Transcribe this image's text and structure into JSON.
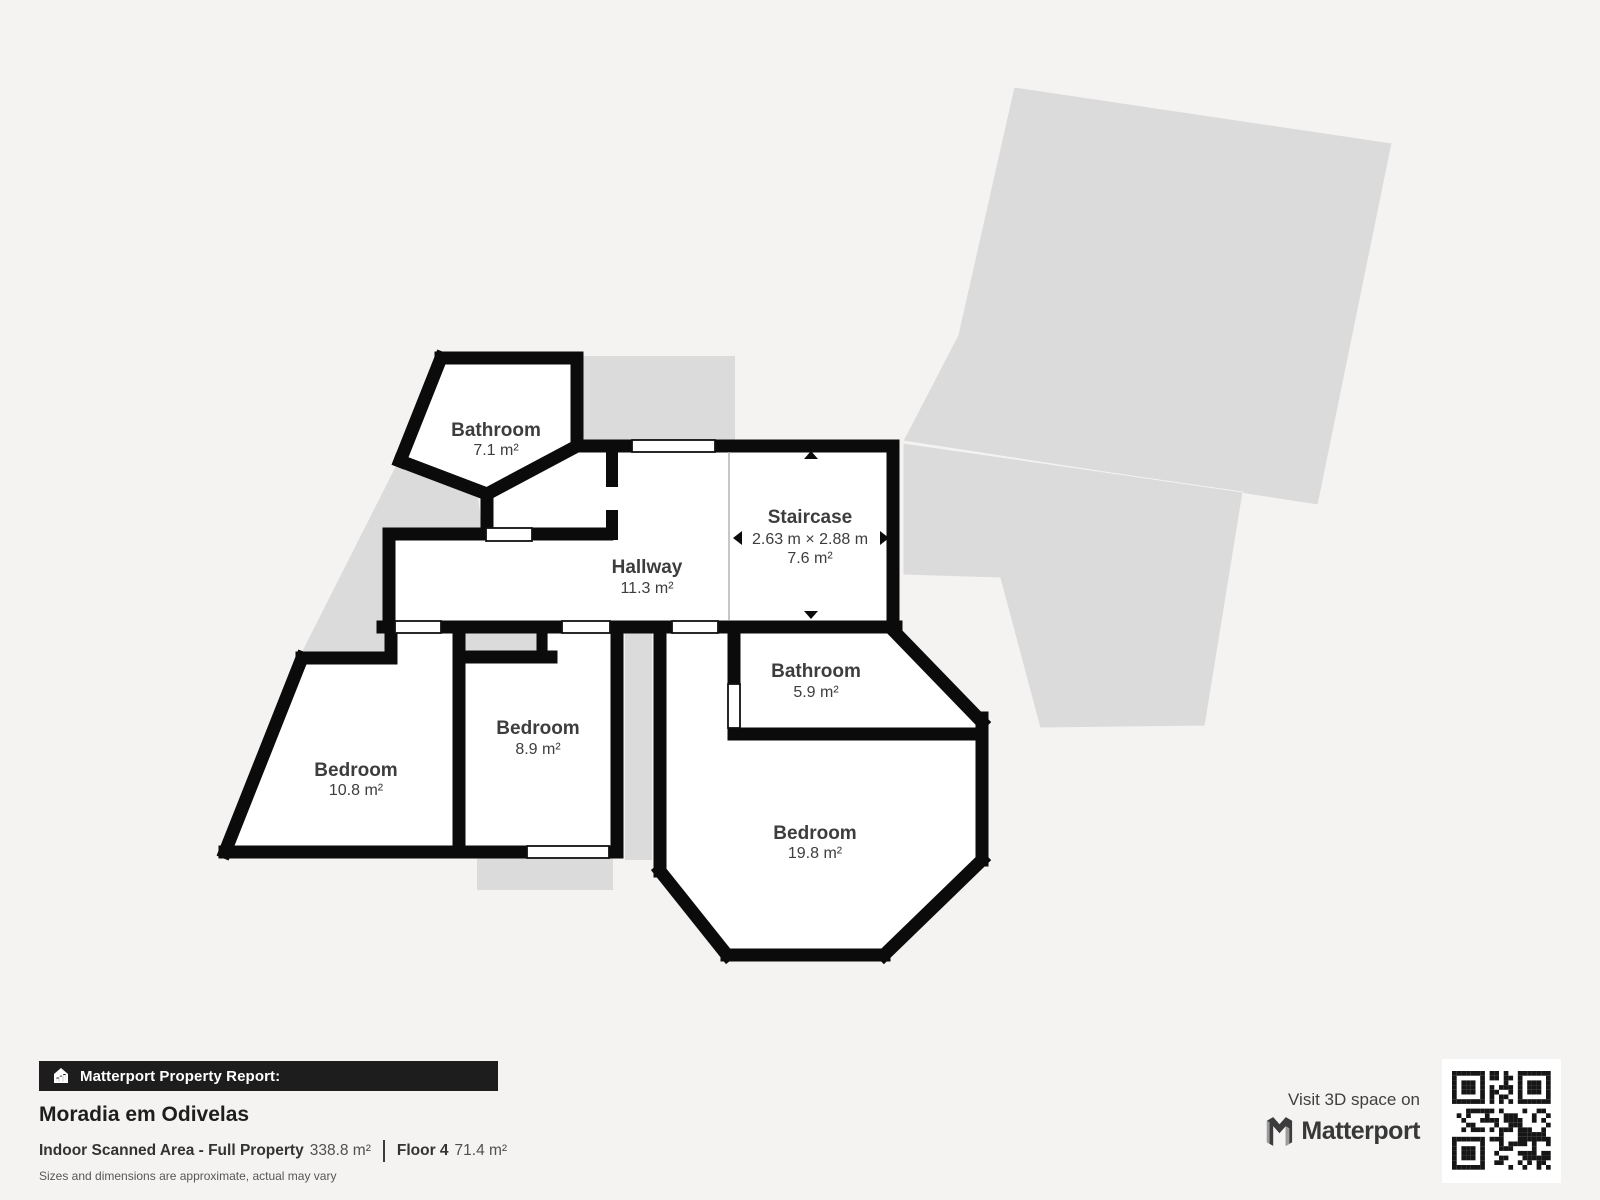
{
  "floor_plan": {
    "rooms": [
      {
        "id": "bathroom-top",
        "name": "Bathroom",
        "area": "7.1 m²"
      },
      {
        "id": "hallway",
        "name": "Hallway",
        "area": "11.3 m²"
      },
      {
        "id": "staircase",
        "name": "Staircase",
        "dimensions": "2.63 m × 2.88 m",
        "area": "7.6 m²"
      },
      {
        "id": "bathroom-mid",
        "name": "Bathroom",
        "area": "5.9 m²"
      },
      {
        "id": "bedroom-small",
        "name": "Bedroom",
        "area": "8.9 m²"
      },
      {
        "id": "bedroom-left",
        "name": "Bedroom",
        "area": "10.8 m²"
      },
      {
        "id": "bedroom-large",
        "name": "Bedroom",
        "area": "19.8 m²"
      }
    ]
  },
  "report": {
    "bar_label": "Matterport Property Report:",
    "property_name": "Moradia em Odivelas",
    "scanned_area_label": "Indoor Scanned Area - Full Property",
    "scanned_area_value": "338.8 m²",
    "floor_label": "Floor 4",
    "floor_value": "71.4 m²",
    "disclaimer": "Sizes and dimensions are approximate, actual may vary"
  },
  "promo": {
    "visit_text": "Visit 3D space on",
    "brand": "Matterport"
  },
  "colors": {
    "background": "#f4f3f2",
    "underlay": "#dbdbdb",
    "walls": "#0b0b0b",
    "room_fill": "#ffffff",
    "label_text": "#3d3d3d",
    "footer_bar": "#1d1d1d"
  }
}
